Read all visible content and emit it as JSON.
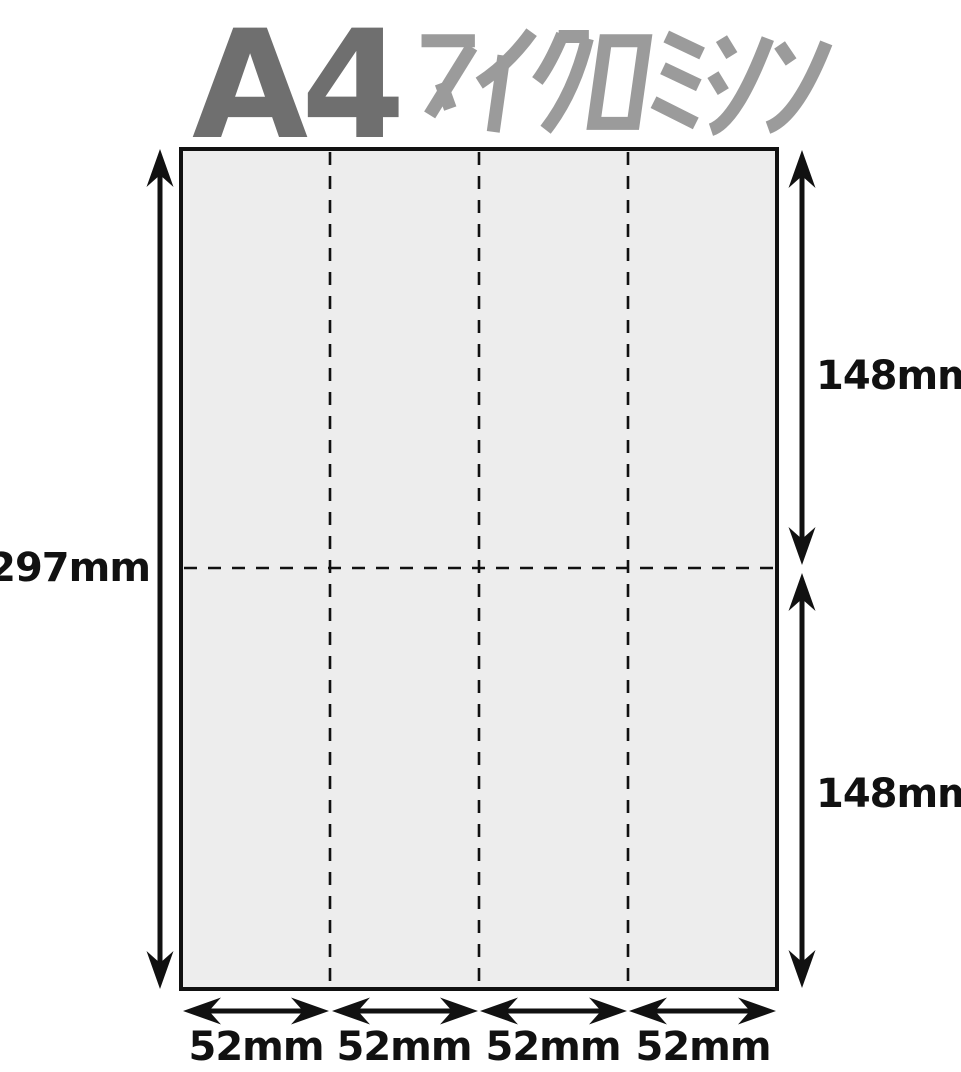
{
  "title": {
    "main": "A4",
    "subtitle": "マイクロミシン",
    "main_color": "#6f6f6f",
    "subtitle_color": "#9b9b9b"
  },
  "sheet": {
    "kind": "A4 sheet with micro-perforation (dashed) lines",
    "fill": "#ededed",
    "border_color": "#111111",
    "columns": 4,
    "rows": 2
  },
  "dimensions": {
    "total_height": "297mm",
    "half_height_top": "148mm",
    "half_height_bottom": "148mm",
    "column_widths": [
      "52mm",
      "52mm",
      "52mm",
      "52mm"
    ]
  }
}
